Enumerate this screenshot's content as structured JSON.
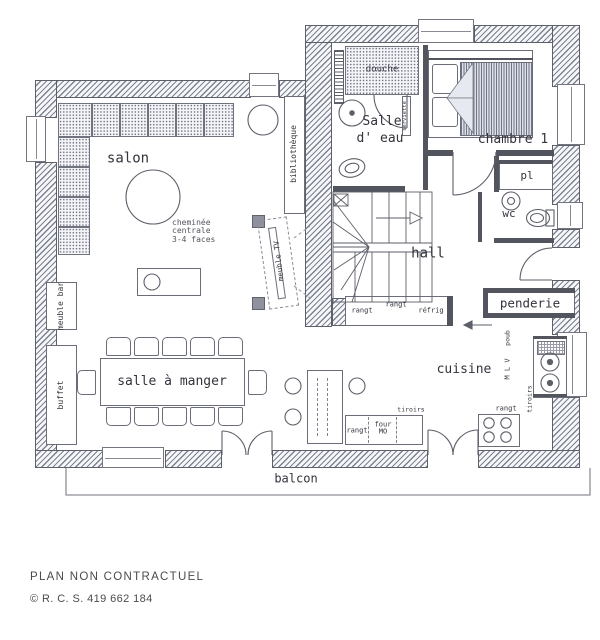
{
  "labels": {
    "salon": "salon",
    "cheminee": "cheminée\ncentrale\n3-4 faces",
    "bibliotheque": "bibliothèque",
    "douche": "douche",
    "salle_eau_1": "Salle",
    "salle_eau_2": "d' eau",
    "serviette": "serviette",
    "chambre": "chambre 1",
    "pl": "pl",
    "wc": "wc",
    "hall": "hall",
    "penderie": "penderie",
    "rangt_a": "rangt",
    "rangt_b": "rangt",
    "refrig": "réfrig",
    "cuisine": "cuisine",
    "poub": "poub",
    "mlv": "M L V",
    "tiroirs_corner": "tiroirs",
    "rangt_hob": "rangt",
    "tiroirs_counter": "tiroirs",
    "rangt_counter": "rangt",
    "four": "four\nMO",
    "salle_a_manger": "salle à manger",
    "meuble_bar": "meuble bar",
    "buffet": "buffet",
    "meuble_tv": "meuble TV",
    "balcon": "balcon"
  },
  "footer": {
    "line1": "PLAN NON CONTRACTUEL",
    "line2": "© R. C. S. 419 662 184"
  }
}
